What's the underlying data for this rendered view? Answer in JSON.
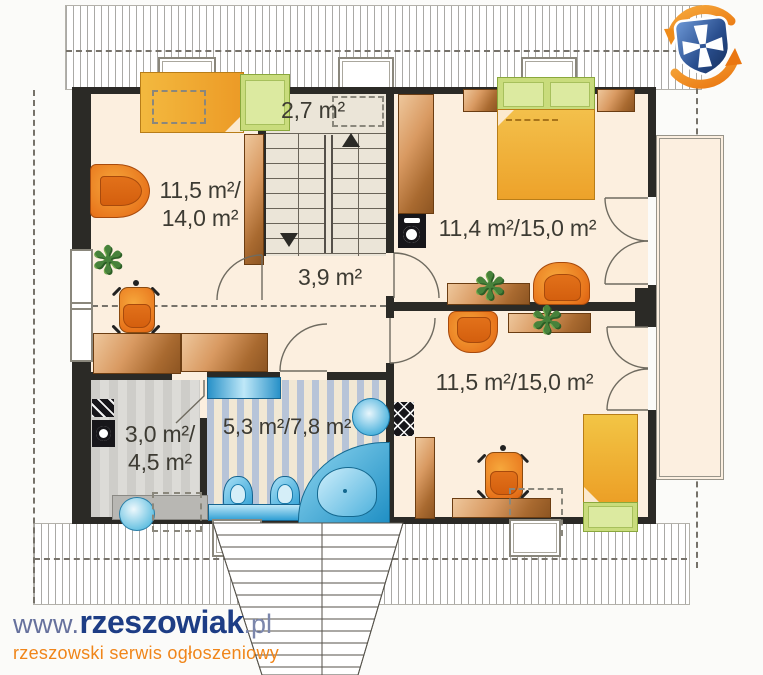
{
  "branding": {
    "url_www": "www.",
    "url_brand": "rzeszowiak",
    "url_tld": ".pl",
    "tagline": "rzeszowski serwis ogłoszeniowy",
    "brand_navy": "#1d3d85",
    "brand_orange": "#f08519",
    "logo_blue": "#2a4f8f",
    "logo_orange": "#ef8c1a"
  },
  "floor_plan": {
    "rooms": {
      "stair_hall": {
        "area_label": "2,7 m²"
      },
      "bedroom_left": {
        "area_label_line1": "11,5 m²/",
        "area_label_line2": "14,0 m²"
      },
      "bedroom_top_right": {
        "area_label": "11,4 m²/15,0 m²"
      },
      "hallway": {
        "area_label": "3,9 m²"
      },
      "bedroom_bottom_right": {
        "area_label": "11,5 m²/15,0 m²"
      },
      "wardrobe_room": {
        "area_label_line1": "3,0 m²/",
        "area_label_line2": "4,5 m²"
      },
      "bathroom": {
        "area_label": "5,3 m²/7,8 m²"
      }
    },
    "colors": {
      "wall": "#2b2a26",
      "floor": "#fcefdf",
      "furniture_orange": "#ee8c24",
      "bed_yellow": "#f2b23a",
      "pillow_green": "#c9dc7c",
      "wood_copper": "#c07a3e",
      "sanitary_blue": "#35a8d8"
    }
  }
}
